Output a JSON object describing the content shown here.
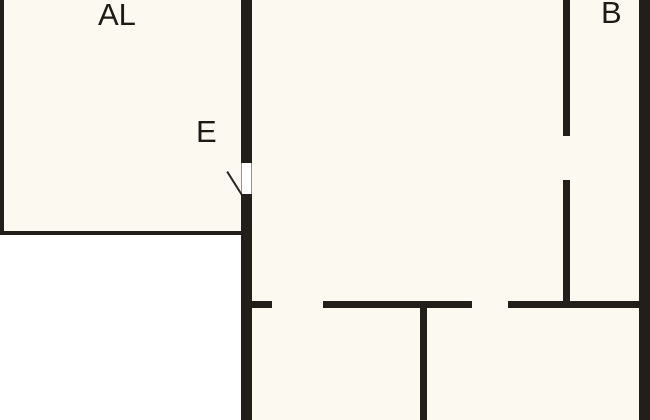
{
  "plan": {
    "type": "floor-plan",
    "rooms": [
      {
        "id": "al",
        "label": "AL"
      },
      {
        "id": "e",
        "label": "E"
      },
      {
        "id": "b",
        "label": "B"
      }
    ],
    "colors": {
      "background": "#FBF9F0",
      "exterior": "#FFFFFF",
      "wall": "#221E19",
      "text": "#1D1B17",
      "door_jamb": "#97948C"
    }
  }
}
